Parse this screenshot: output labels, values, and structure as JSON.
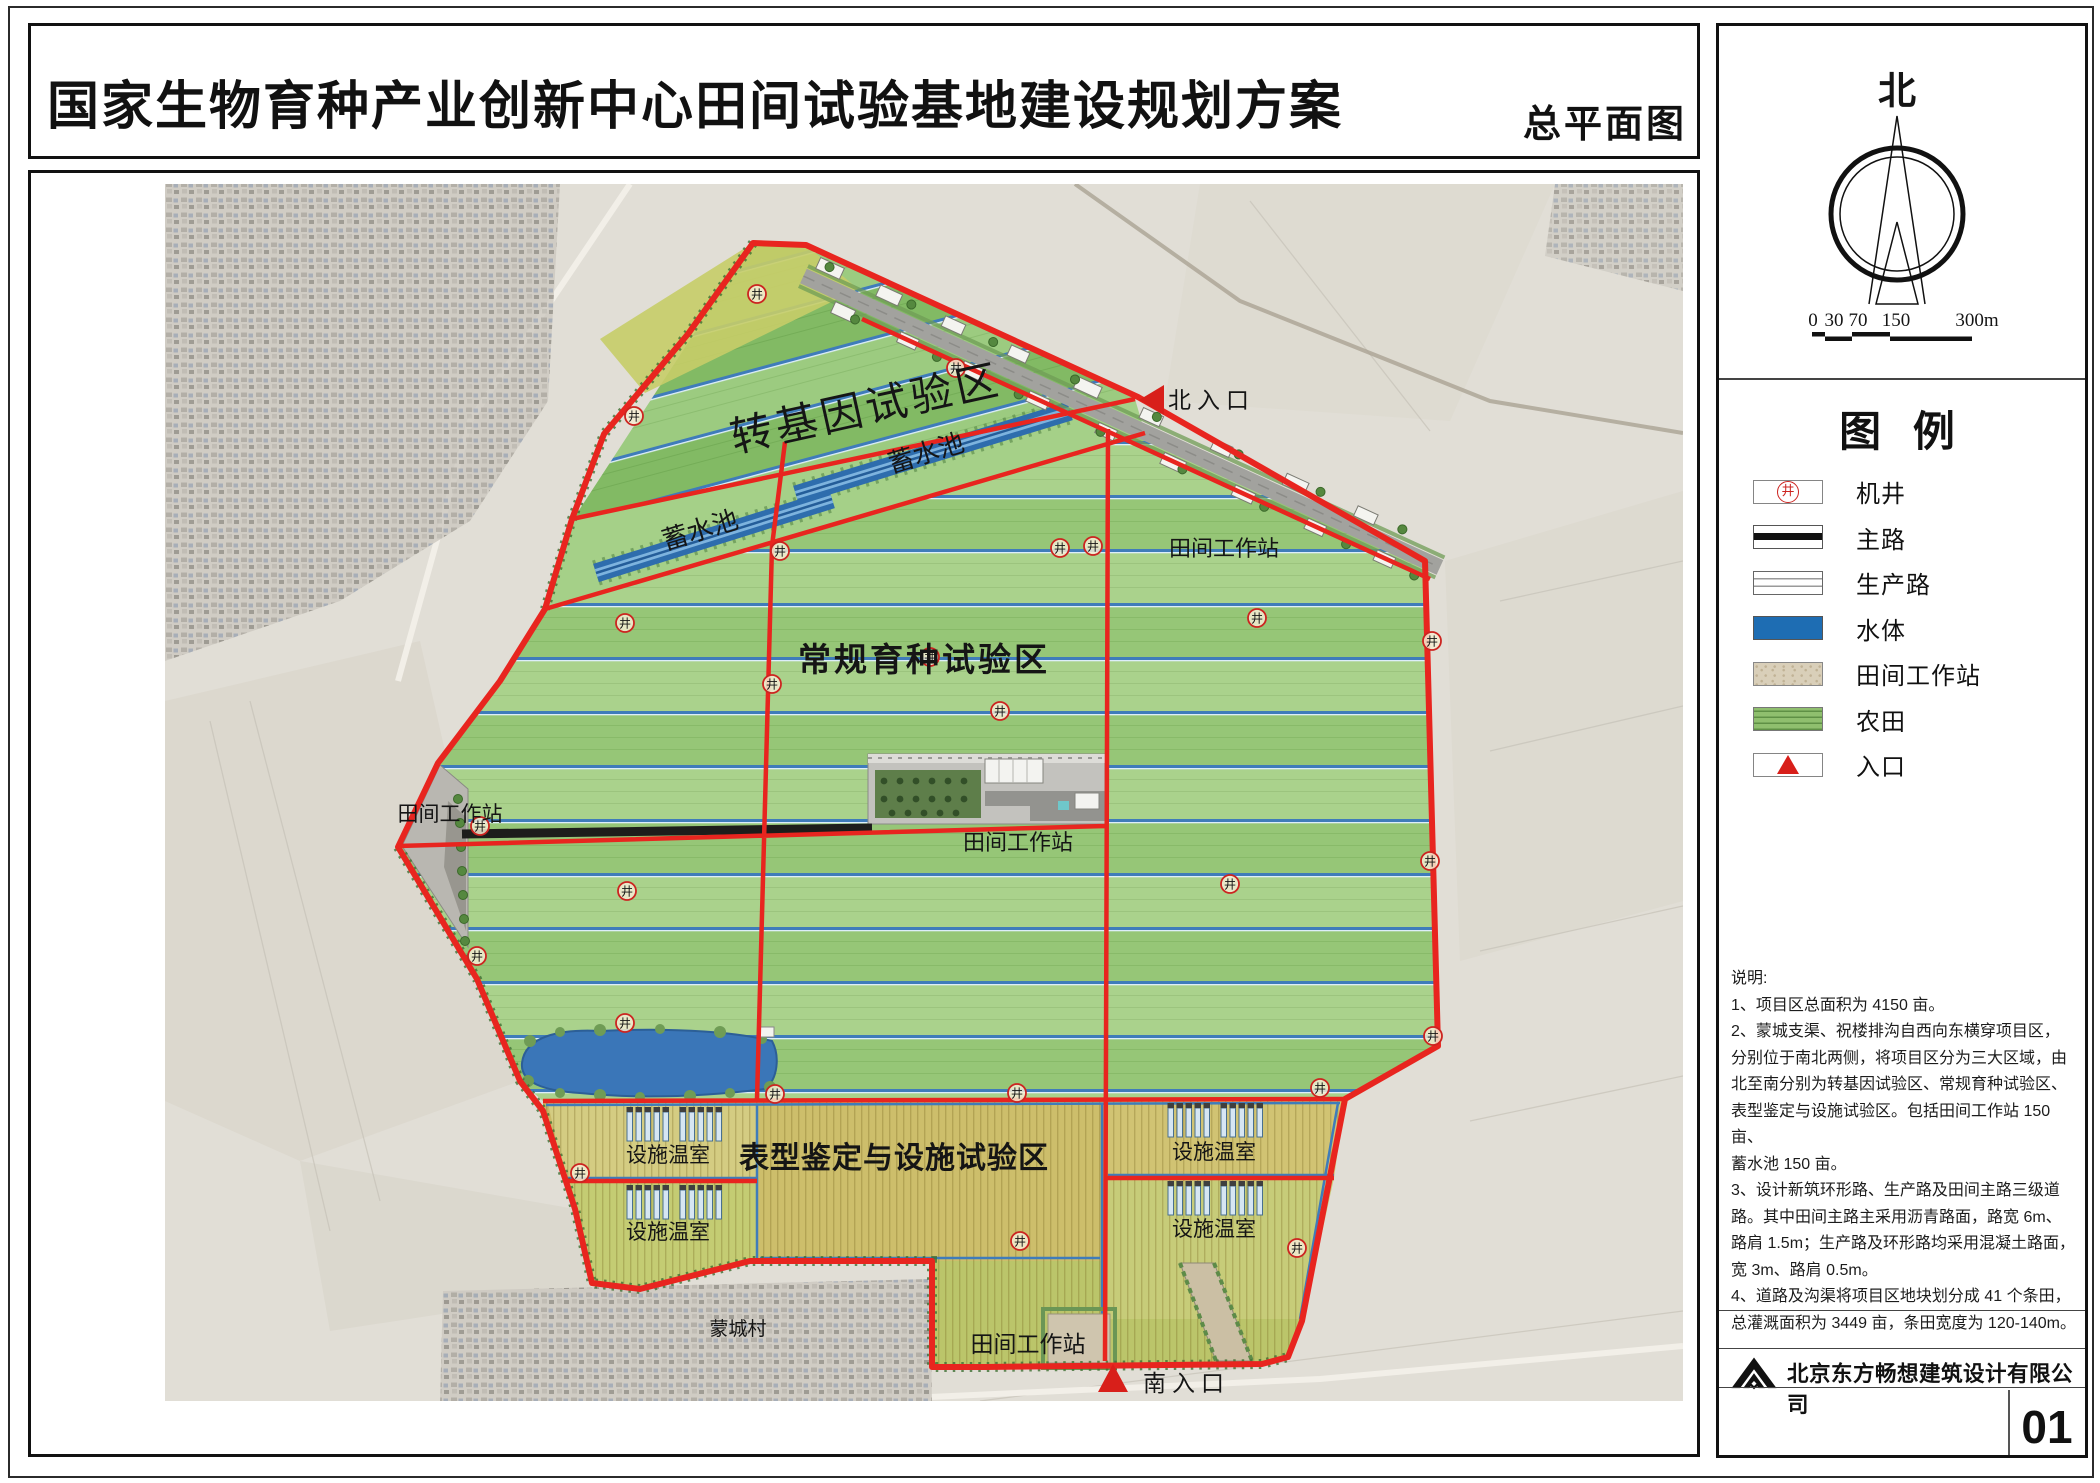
{
  "page": {
    "outer_title": "国家生物育种产业创新中心田间试验基地建设规划方案",
    "sheet_label": "总平面图",
    "sheet_number": "01",
    "company_name": "北京东方畅想建筑设计有限公司"
  },
  "north_arrow": {
    "label": "北"
  },
  "scale_bar": {
    "ticks": [
      "0",
      "30",
      "70",
      "150",
      "300m"
    ]
  },
  "legend": {
    "heading": "图  例",
    "items": [
      {
        "name": "well",
        "label": "机井"
      },
      {
        "name": "main-road",
        "label": "主路"
      },
      {
        "name": "production-road",
        "label": "生产路"
      },
      {
        "name": "water",
        "label": "水体"
      },
      {
        "name": "field-station",
        "label": "田间工作站"
      },
      {
        "name": "farmland",
        "label": "农田"
      },
      {
        "name": "entrance",
        "label": "入口"
      }
    ]
  },
  "notes": {
    "heading": "说明:",
    "lines": [
      "1、项目区总面积为 4150 亩。",
      "2、蒙城支渠、祝楼排沟自西向东横穿项目区，",
      "分别位于南北两侧，将项目区分为三大区域，由",
      "北至南分别为转基因试验区、常规育种试验区、",
      "表型鉴定与设施试验区。包括田间工作站 150 亩、",
      "蓄水池 150 亩。",
      "3、设计新筑环形路、生产路及田间主路三级道",
      "路。其中田间主路主采用沥青路面，路宽 6m、",
      "路肩 1.5m；生产路及环形路均采用混凝土路面，",
      "宽 3m、路肩 0.5m。",
      "4、道路及沟渠将项目区地块划分成 41 个条田，",
      "总灌溉面积为 3449 亩，条田宽度为 120-140m。"
    ]
  },
  "map": {
    "well_glyph": "井",
    "labels": {
      "zone_north": "转基因试验区",
      "zone_middle": "常规育种试验区",
      "zone_south": "表型鉴定与设施试验区",
      "reservoir": "蓄水池",
      "field_station": "田间工作站",
      "greenhouse": "设施温室",
      "village": "蒙城村",
      "entrance_north": "北入口",
      "entrance_south": "南入口"
    }
  },
  "colors": {
    "boundary_red": "#e8251f",
    "water_blue": "#1e6db3",
    "farmland_green": "#8fbf6e",
    "station_tan": "#d9cfb9",
    "road_black": "#1c1c1c"
  }
}
